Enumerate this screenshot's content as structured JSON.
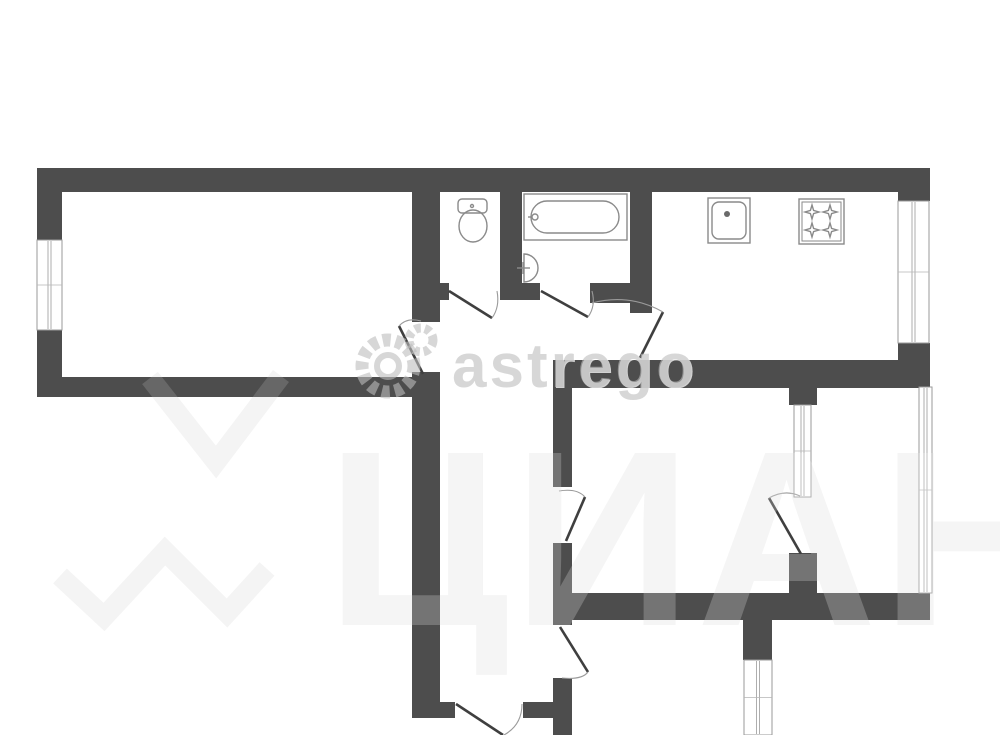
{
  "watermarks": {
    "brand": "astrego",
    "portal": "ЦИАН"
  },
  "plan": {
    "bg_color": "#ffffff",
    "wall_color": "#4d4d4d",
    "line_color": "#8a8a8a",
    "window_line_color": "#9a9a9a",
    "door_leaf_color": "#3f3f3f",
    "arc_color": "#9a9a9a",
    "walls": [
      [
        37,
        168,
        893,
        24
      ],
      [
        37,
        192,
        25,
        48
      ],
      [
        37,
        330,
        25,
        67
      ],
      [
        37,
        377,
        375,
        20
      ],
      [
        412,
        192,
        28,
        130
      ],
      [
        412,
        372,
        28,
        346
      ],
      [
        440,
        702,
        15,
        16
      ],
      [
        523,
        702,
        30,
        16
      ],
      [
        500,
        192,
        22,
        108
      ],
      [
        440,
        283,
        9,
        17
      ],
      [
        500,
        283,
        40,
        17
      ],
      [
        590,
        283,
        53,
        20
      ],
      [
        630,
        192,
        22,
        121
      ],
      [
        553,
        360,
        377,
        28
      ],
      [
        898,
        168,
        32,
        33
      ],
      [
        898,
        343,
        32,
        45
      ],
      [
        553,
        388,
        19,
        99
      ],
      [
        553,
        543,
        19,
        82
      ],
      [
        553,
        678,
        19,
        57
      ],
      [
        789,
        388,
        28,
        17
      ],
      [
        789,
        553,
        28,
        40
      ],
      [
        553,
        593,
        377,
        27
      ],
      [
        743,
        620,
        29,
        40
      ]
    ],
    "windows": [
      {
        "x": 37,
        "y": 240,
        "w": 25,
        "h": 90
      },
      {
        "x": 898,
        "y": 201,
        "w": 31,
        "h": 142
      },
      {
        "x": 919,
        "y": 387,
        "w": 13,
        "h": 206
      },
      {
        "x": 794,
        "y": 405,
        "w": 17,
        "h": 92
      },
      {
        "x": 744,
        "y": 660,
        "w": 28,
        "h": 75
      }
    ],
    "doors": [
      {
        "name": "left-room-door",
        "leaf": [
          423,
          374,
          399,
          326
        ],
        "arc": "M399,326 Q407,317 421,321"
      },
      {
        "name": "wc-door",
        "leaf": [
          449,
          291,
          492,
          318
        ],
        "arc": "M492,318 Q500,307 497,291"
      },
      {
        "name": "bath-door",
        "leaf": [
          541,
          291,
          588,
          317
        ],
        "arc": "M588,317 Q596,306 592,291"
      },
      {
        "name": "kitchen-door",
        "leaf": [
          640,
          358,
          663,
          312
        ],
        "arc": "M663,312 Q629,293 592,303"
      },
      {
        "name": "middle-room-door",
        "leaf": [
          566,
          541,
          585,
          497
        ],
        "arc": "M585,497 Q577,488 559,491"
      },
      {
        "name": "bottom-room-door",
        "leaf": [
          560,
          627,
          588,
          672
        ],
        "arc": "M588,672 Q582,680 562,678"
      },
      {
        "name": "corridor-south-door",
        "leaf": [
          456,
          704,
          503,
          735
        ],
        "arc": "M522,704 Q522,725 504,735"
      },
      {
        "name": "balcony-door",
        "leaf": [
          801,
          554,
          769,
          498
        ],
        "arc": "M769,498 Q785,489 800,496"
      }
    ],
    "fixtures": [
      {
        "name": "toilet-icon",
        "shapes": [
          {
            "t": "rect",
            "a": {
              "x": 458,
              "y": 199,
              "width": 29,
              "height": 14,
              "rx": 4
            }
          },
          {
            "t": "ellipse",
            "a": {
              "cx": 473,
              "cy": 226,
              "rx": 14,
              "ry": 16
            }
          },
          {
            "t": "circle",
            "a": {
              "cx": 472,
              "cy": 206,
              "r": 1.5
            }
          }
        ]
      },
      {
        "name": "bathtub-icon",
        "shapes": [
          {
            "t": "rect",
            "a": {
              "x": 524,
              "y": 194,
              "width": 103,
              "height": 46
            }
          },
          {
            "t": "rect",
            "a": {
              "x": 531,
              "y": 201,
              "width": 88,
              "height": 32,
              "rx": 16
            }
          },
          {
            "t": "circle",
            "a": {
              "cx": 535,
              "cy": 217,
              "r": 3
            }
          },
          {
            "t": "line",
            "a": {
              "x1": 528,
              "y1": 217,
              "x2": 532,
              "y2": 217
            }
          }
        ]
      },
      {
        "name": "bath-sink-icon",
        "shapes": [
          {
            "t": "path",
            "a": {
              "d": "M524,254 A14,14 0 0 1 524,282 Z"
            }
          },
          {
            "t": "line",
            "a": {
              "x1": 517,
              "y1": 268,
              "x2": 530,
              "y2": 268
            }
          },
          {
            "t": "line",
            "a": {
              "x1": 523,
              "y1": 262,
              "x2": 523,
              "y2": 274
            }
          }
        ]
      },
      {
        "name": "kitchen-sink-icon",
        "shapes": [
          {
            "t": "rect",
            "a": {
              "x": 708,
              "y": 198,
              "width": 42,
              "height": 45
            }
          },
          {
            "t": "rect",
            "a": {
              "x": 712,
              "y": 202,
              "width": 34,
              "height": 37,
              "rx": 7
            }
          },
          {
            "t": "circle",
            "a": {
              "cx": 727,
              "cy": 214,
              "r": 3,
              "fill": "#6a6a6a",
              "stroke": "none"
            }
          }
        ]
      },
      {
        "name": "stove-icon",
        "shapes": [
          {
            "t": "rect",
            "a": {
              "x": 799,
              "y": 199,
              "width": 45,
              "height": 45
            }
          },
          {
            "t": "rect",
            "a": {
              "x": 802,
              "y": 202,
              "width": 39,
              "height": 39,
              "stroke-width": 1
            }
          },
          {
            "t": "path",
            "a": {
              "d": "M812 205 L813.6 210.4 L819 212 L813.6 213.6 L812 219 L810.4 213.6 L805 212 L810.4 210.4 Z"
            }
          },
          {
            "t": "path",
            "a": {
              "d": "M830 205 L831.6 210.4 L837 212 L831.6 213.6 L830 219 L828.4 213.6 L823 212 L828.4 210.4 Z"
            }
          },
          {
            "t": "path",
            "a": {
              "d": "M812 223 L813.6 228.4 L819 230 L813.6 231.6 L812 237 L810.4 231.6 L805 230 L810.4 228.4 Z"
            }
          },
          {
            "t": "path",
            "a": {
              "d": "M830 223 L831.6 228.4 L837 230 L831.6 231.6 L830 237 L828.4 231.6 L823 230 L828.4 228.4 Z"
            }
          }
        ]
      }
    ]
  }
}
